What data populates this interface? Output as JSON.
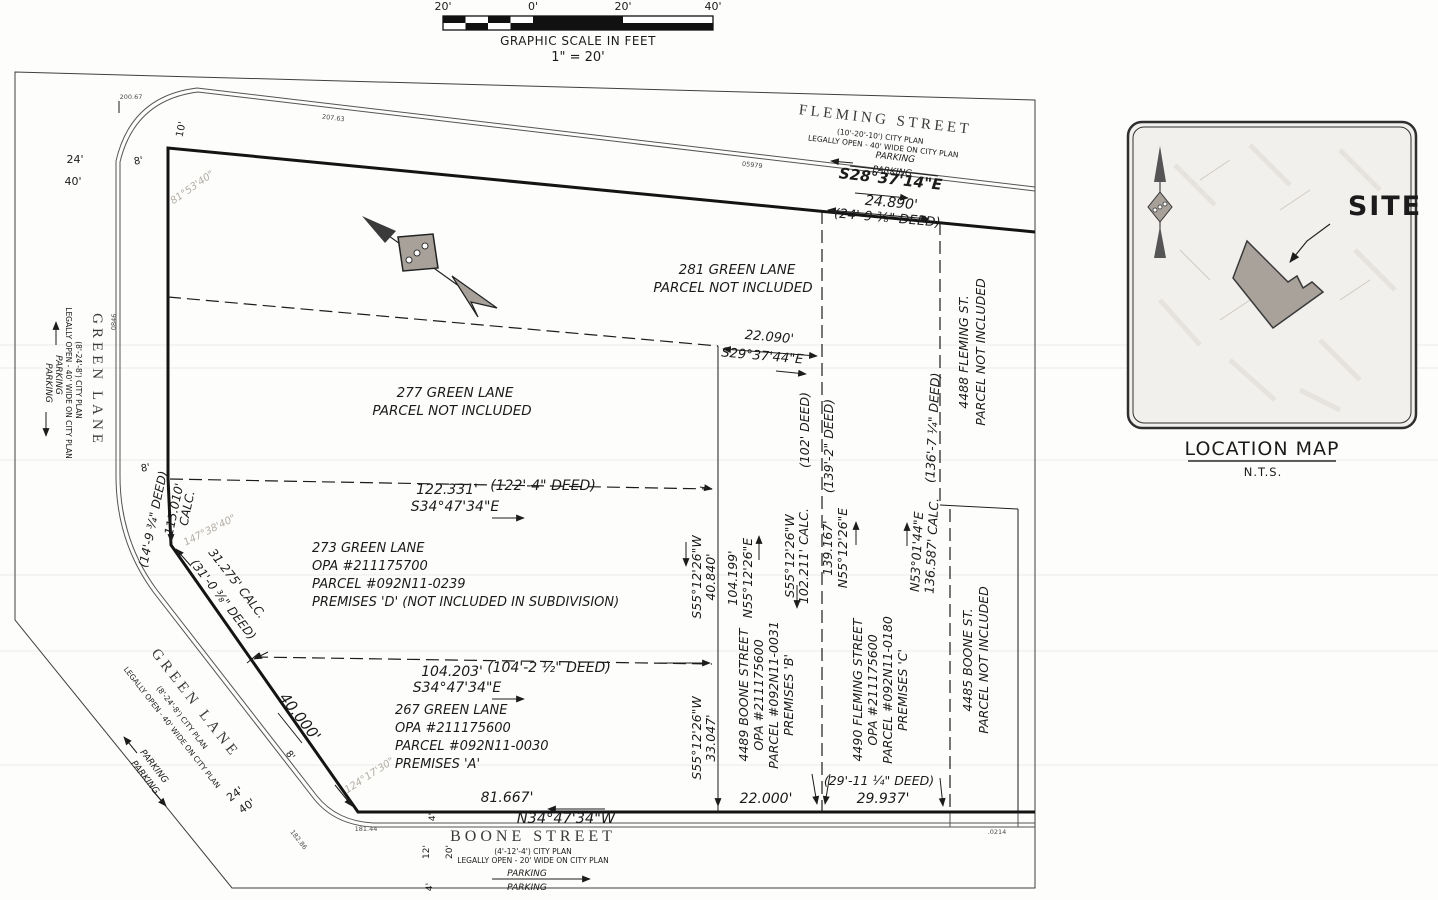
{
  "scale": {
    "t1": "20'",
    "t2": "0'",
    "t3": "20'",
    "t4": "40'",
    "title": "GRAPHIC SCALE IN FEET",
    "ratio": "1\" = 20'"
  },
  "streets": {
    "fleming": {
      "name": "FLEMING STREET",
      "plan": "(10'-20'-10') CITY PLAN",
      "open": "LEGALLY OPEN - 40' WIDE ON CITY PLAN",
      "parking": "PARKING",
      "bearing": "S28°37'14\"E"
    },
    "green_w": {
      "name": "GREEN LANE",
      "plan": "(8'-24'-8') CITY PLAN",
      "open": "LEGALLY OPEN - 40' WIDE ON CITY PLAN",
      "parking": "PARKING"
    },
    "green_s": {
      "name": "GREEN LANE",
      "plan": "(8'-24'-8') CITY PLAN",
      "open": "LEGALLY OPEN - 40' WIDE ON CITY PLAN",
      "parking": "PARKING"
    },
    "boone": {
      "name": "BOONE STREET",
      "plan": "(4'-12'-4') CITY PLAN",
      "open": "LEGALLY OPEN - 20' WIDE ON CITY PLAN",
      "parking": "PARKING",
      "bearing": "N34°47'34\"W"
    }
  },
  "parcels": {
    "p281a": "281 GREEN LANE",
    "p281b": "PARCEL NOT INCLUDED",
    "p277a": "277 GREEN LANE",
    "p277b": "PARCEL NOT INCLUDED",
    "p273": {
      "l1": "273 GREEN LANE",
      "l2": "OPA #211175700",
      "l3": "PARCEL #092N11-0239",
      "l4": "PREMISES 'D' (NOT INCLUDED IN SUBDIVISION)"
    },
    "p267": {
      "l1": "267 GREEN LANE",
      "l2": "OPA #211175600",
      "l3": "PARCEL #092N11-0030",
      "l4": "PREMISES 'A'"
    },
    "p4489": {
      "l1": "4489 BOONE STREET",
      "l2": "OPA #211175600",
      "l3": "PARCEL #092N11-0031",
      "l4": "PREMISES 'B'"
    },
    "p4490": {
      "l1": "4490 FLEMING STREET",
      "l2": "OPA #211175600",
      "l3": "PARCEL #092N11-0180",
      "l4": "PREMISES 'C'"
    },
    "p4488a": "4488 FLEMING ST.",
    "p4488b": "PARCEL NOT INCLUDED",
    "p4485a": "4485 BOONE ST.",
    "p4485b": "PARCEL NOT INCLUDED"
  },
  "dims": {
    "d24890": "24.890'",
    "d24890d": "(24'-9 ⅜\" DEED)",
    "d22090": "22.090'",
    "b2937": "S29°37'44\"E",
    "d122": "122.331'",
    "d122d": "(122'-4\" DEED)",
    "b3447se": "S34°47'34\"E",
    "d104": "104.203'",
    "d104d": "(104'-2 ½\" DEED)",
    "d81": "81.667'",
    "b3447nw": "N34°47'34\"W",
    "d22000": "22.000'",
    "d29": "29.937'",
    "d29d": "(29'-11 ¼\" DEED)",
    "d115": "115.010'",
    "calc": "CALC.",
    "d115d": "(14'-9 ¾\" DEED)",
    "d31": "31.275' CALC.",
    "d31d": "(31'-0 ⅜\" DEED)",
    "d40000": "40.000'",
    "b5512w": "S55°12'26\"W",
    "d40840": "40.840'",
    "d104199": "104.199'",
    "b5512e": "N55°12'26\"E",
    "d102": "102.211' CALC.",
    "d102d": "(102' DEED)",
    "d139": "139.167'",
    "d139d": "(139'-2\" DEED)",
    "b5301": "N53°01'44\"E",
    "d136": "136.587' CALC.",
    "d136d": "(136'-7 ¼\" DEED)",
    "d33": "33.047'"
  },
  "angles": {
    "a81": "81°53'40\"",
    "a147": "147°38'40\"",
    "a124": "124°17'30\""
  },
  "stations": {
    "s1": "200.67",
    "s2": "207.63",
    "s3": "0846",
    "s4": "05979",
    "s5": "182.86",
    "s6": "181.44",
    "s7": ".0214"
  },
  "edges": {
    "e8_top": "8'",
    "e10": "10'",
    "e24_top": "24'",
    "e40_top": "40'",
    "e8_mid": "8'",
    "e8_diag": "8'",
    "e24_bot": "24'",
    "e40_bot": "40'",
    "e4_a": "4'",
    "e12": "12'",
    "e20": "20'",
    "e4_b": "4'"
  },
  "map": {
    "site": "SITE",
    "title": "LOCATION MAP",
    "nts": "N.T.S."
  }
}
